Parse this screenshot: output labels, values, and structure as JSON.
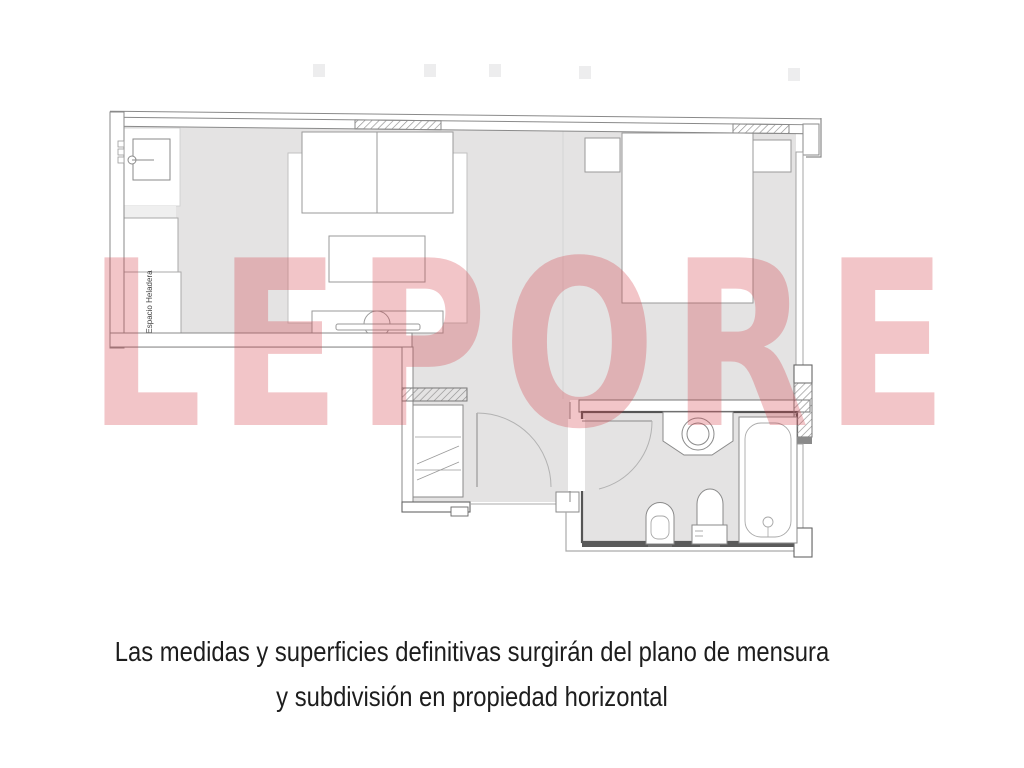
{
  "watermark": {
    "text": "LEPORE",
    "color": "#d33e48",
    "opacity": 0.3
  },
  "floorplan": {
    "appliance_label": "Espacio Heladera",
    "rooms_labeled": false
  },
  "disclaimer": {
    "line1": "Las medidas y superficies definitivas surgirán del plano de mensura",
    "line2": "y subdivisión en propiedad horizontal"
  },
  "colors": {
    "floor_gray": "#e4e3e3",
    "wall_line": "#8a8a8a",
    "wall_dark": "#5a5a5a",
    "furniture_stroke": "#9a9a9a",
    "watermark_red": "#d33e48",
    "text_dark": "#1d1d1d",
    "background": "#ffffff"
  }
}
